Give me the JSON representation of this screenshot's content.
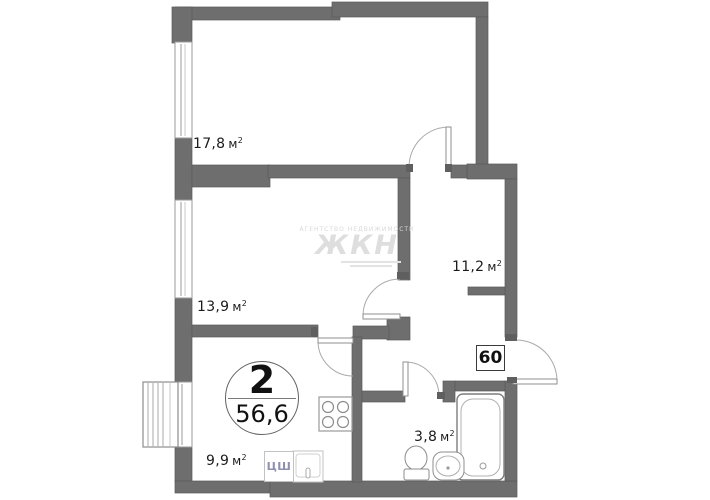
{
  "plan": {
    "title": "2-room apartment floor plan",
    "rooms": [
      {
        "name": "living-room",
        "area": "17,8"
      },
      {
        "name": "bedroom",
        "area": "13,9"
      },
      {
        "name": "hallway",
        "area": "11,2"
      },
      {
        "name": "kitchen",
        "area": "9,9"
      },
      {
        "name": "bathroom",
        "area": "3,8"
      }
    ],
    "unit_m": "м",
    "unit_sup": "2",
    "apartment_badge": {
      "rooms_count": "2",
      "total_area": "56,6"
    },
    "entrance_number": "60",
    "closet_label": "ЦШ",
    "watermark": {
      "caption": "АГЕНТСТВО НЕДВИЖИМОСТИ",
      "logo": "ЖКН"
    },
    "colors": {
      "wall": "#6e6e6e",
      "wall_edge": "#5a5a5a",
      "thin_line": "#9a9a9a",
      "label_text": "#1b1b1b",
      "closet_text": "#8f8fb2"
    }
  }
}
